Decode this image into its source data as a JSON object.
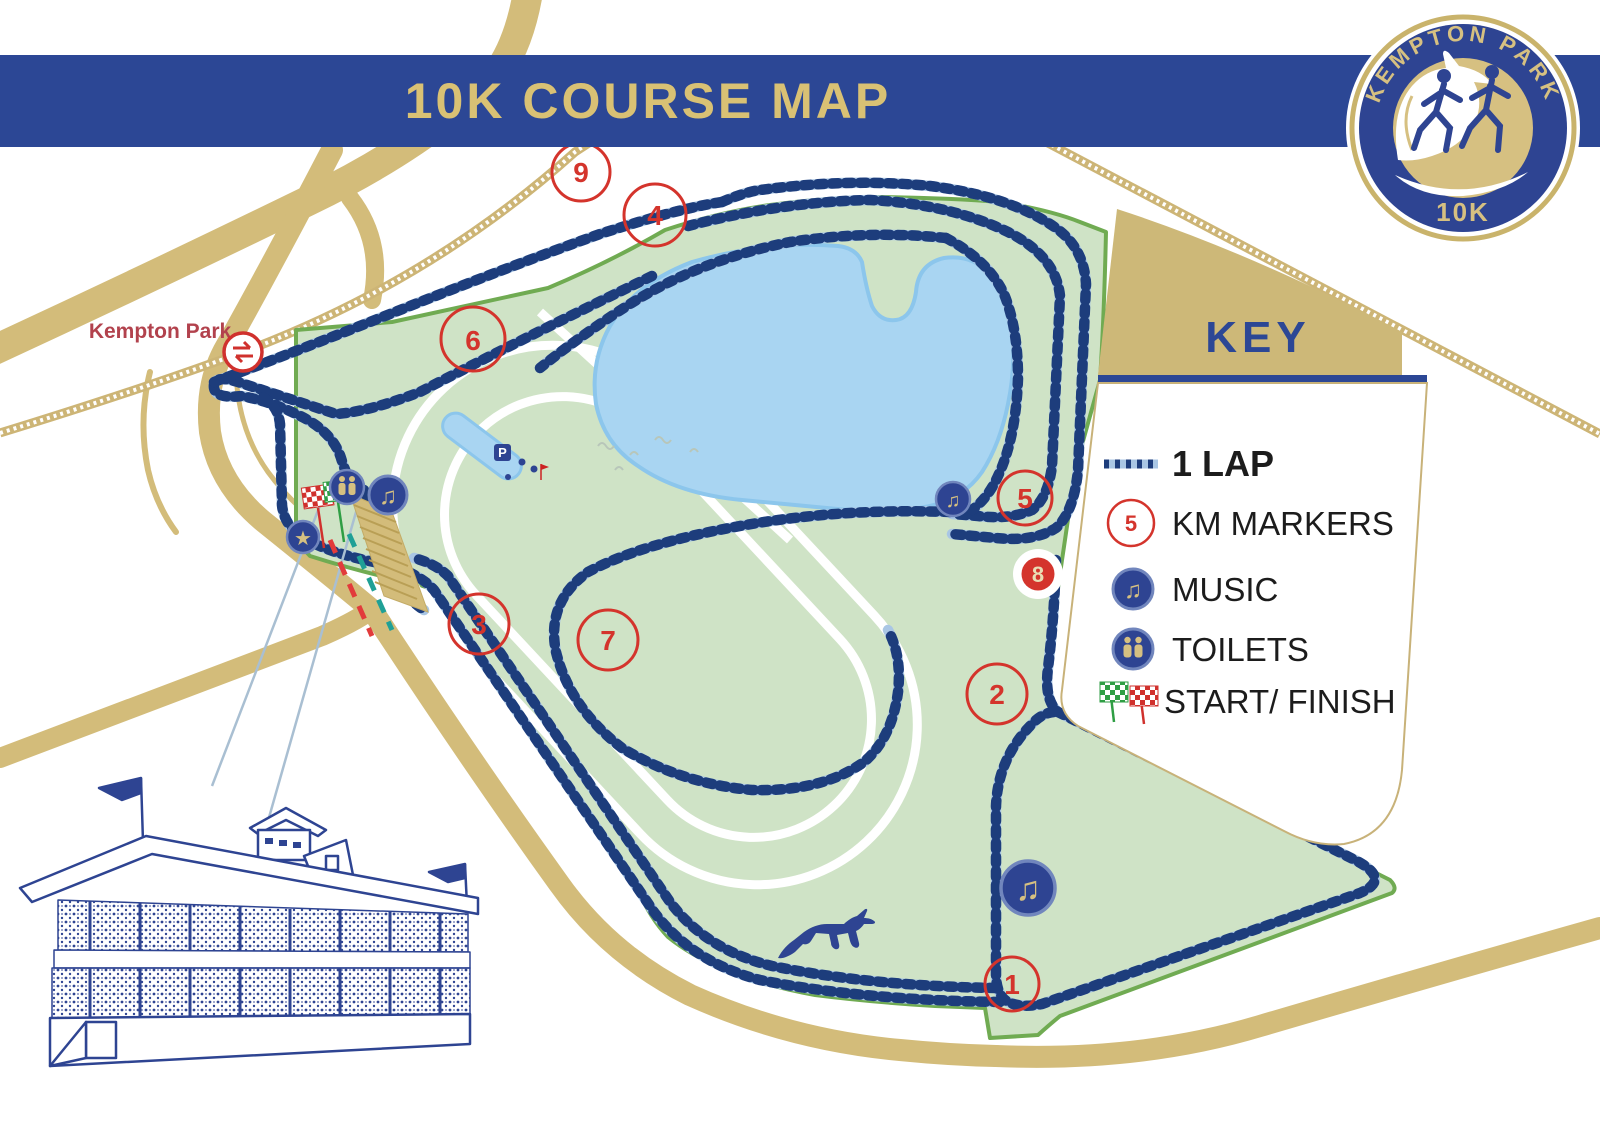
{
  "banner": {
    "title": "10K COURSE MAP",
    "color": "#2c4795",
    "text_color": "#d9c174"
  },
  "logo": {
    "arc_text": "KEMPTON PARK",
    "event": "10K"
  },
  "key": {
    "title": "KEY",
    "km_sample": "5",
    "items": {
      "lap": "1 LAP",
      "km": "KM MARKERS",
      "music": "MUSIC",
      "toilets": "TOILETS",
      "start": "START/ FINISH"
    }
  },
  "map": {
    "labels": {
      "motorway": "M3",
      "road": "Country Way",
      "station": "Kempton Park",
      "parking": "P"
    },
    "km_markers": [
      {
        "n": "1",
        "x": 1012,
        "y": 984,
        "style": "ring"
      },
      {
        "n": "2",
        "x": 997,
        "y": 694,
        "style": "ring"
      },
      {
        "n": "3",
        "x": 479,
        "y": 624,
        "style": "ring"
      },
      {
        "n": "4",
        "x": 655,
        "y": 215,
        "style": "ring"
      },
      {
        "n": "5",
        "x": 1025,
        "y": 498,
        "style": "ring"
      },
      {
        "n": "6",
        "x": 473,
        "y": 339,
        "style": "ring"
      },
      {
        "n": "7",
        "x": 608,
        "y": 640,
        "style": "ring"
      },
      {
        "n": "8",
        "x": 1038,
        "y": 574,
        "style": "solid-red-on-white"
      },
      {
        "n": "9",
        "x": 581,
        "y": 172,
        "style": "ring"
      }
    ],
    "colors": {
      "course_green": "#cfe3c6",
      "course_border": "#70ab52",
      "lake_blue": "#a9d5f2",
      "lake_border": "#8cc6ec",
      "road_gold": "#d3bc7a",
      "route_navy": "#1d3d7c",
      "route_light": "#a9c6e4",
      "marker_red": "#d4342c",
      "station_text": "#b2424d",
      "start_funnel_red": "#e23b3b",
      "start_funnel_teal": "#1fa096"
    }
  },
  "icons": {
    "music": "♫",
    "star": "★"
  }
}
